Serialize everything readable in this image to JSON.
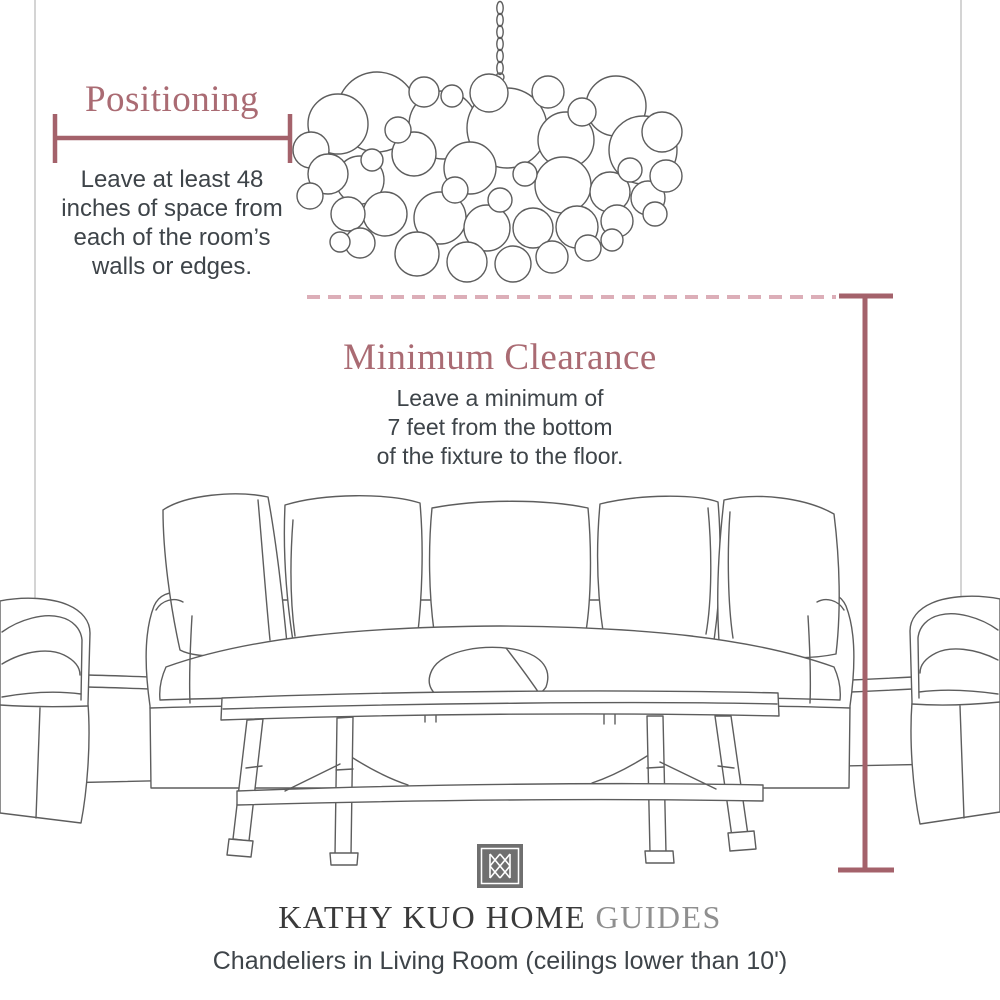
{
  "colors": {
    "accent": "#a4626b",
    "accent_light": "#dcaeb8",
    "heading": "#aa6b73",
    "text": "#3e4449",
    "sketch": "#5d5d5d",
    "wall": "#c9c9c9",
    "brand_dark": "#3a3a3a",
    "brand_light": "#8f8f8f",
    "logo_bg": "#6f6f6f"
  },
  "positioning": {
    "title": "Positioning",
    "lines": [
      "Leave at least 48",
      "inches of space from",
      "each of the room’s",
      "walls or edges."
    ]
  },
  "clearance": {
    "title": "Minimum Clearance",
    "lines": [
      "Leave a minimum of",
      "7 feet from the bottom",
      "of the fixture to the floor."
    ]
  },
  "footer": {
    "brand_main": "KATHY KUO HOME",
    "brand_suffix": "GUIDES",
    "caption": "Chandeliers in Living Room (ceilings lower than 10')"
  },
  "icons": {
    "logo": "kathy-kuo-home-monogram"
  }
}
